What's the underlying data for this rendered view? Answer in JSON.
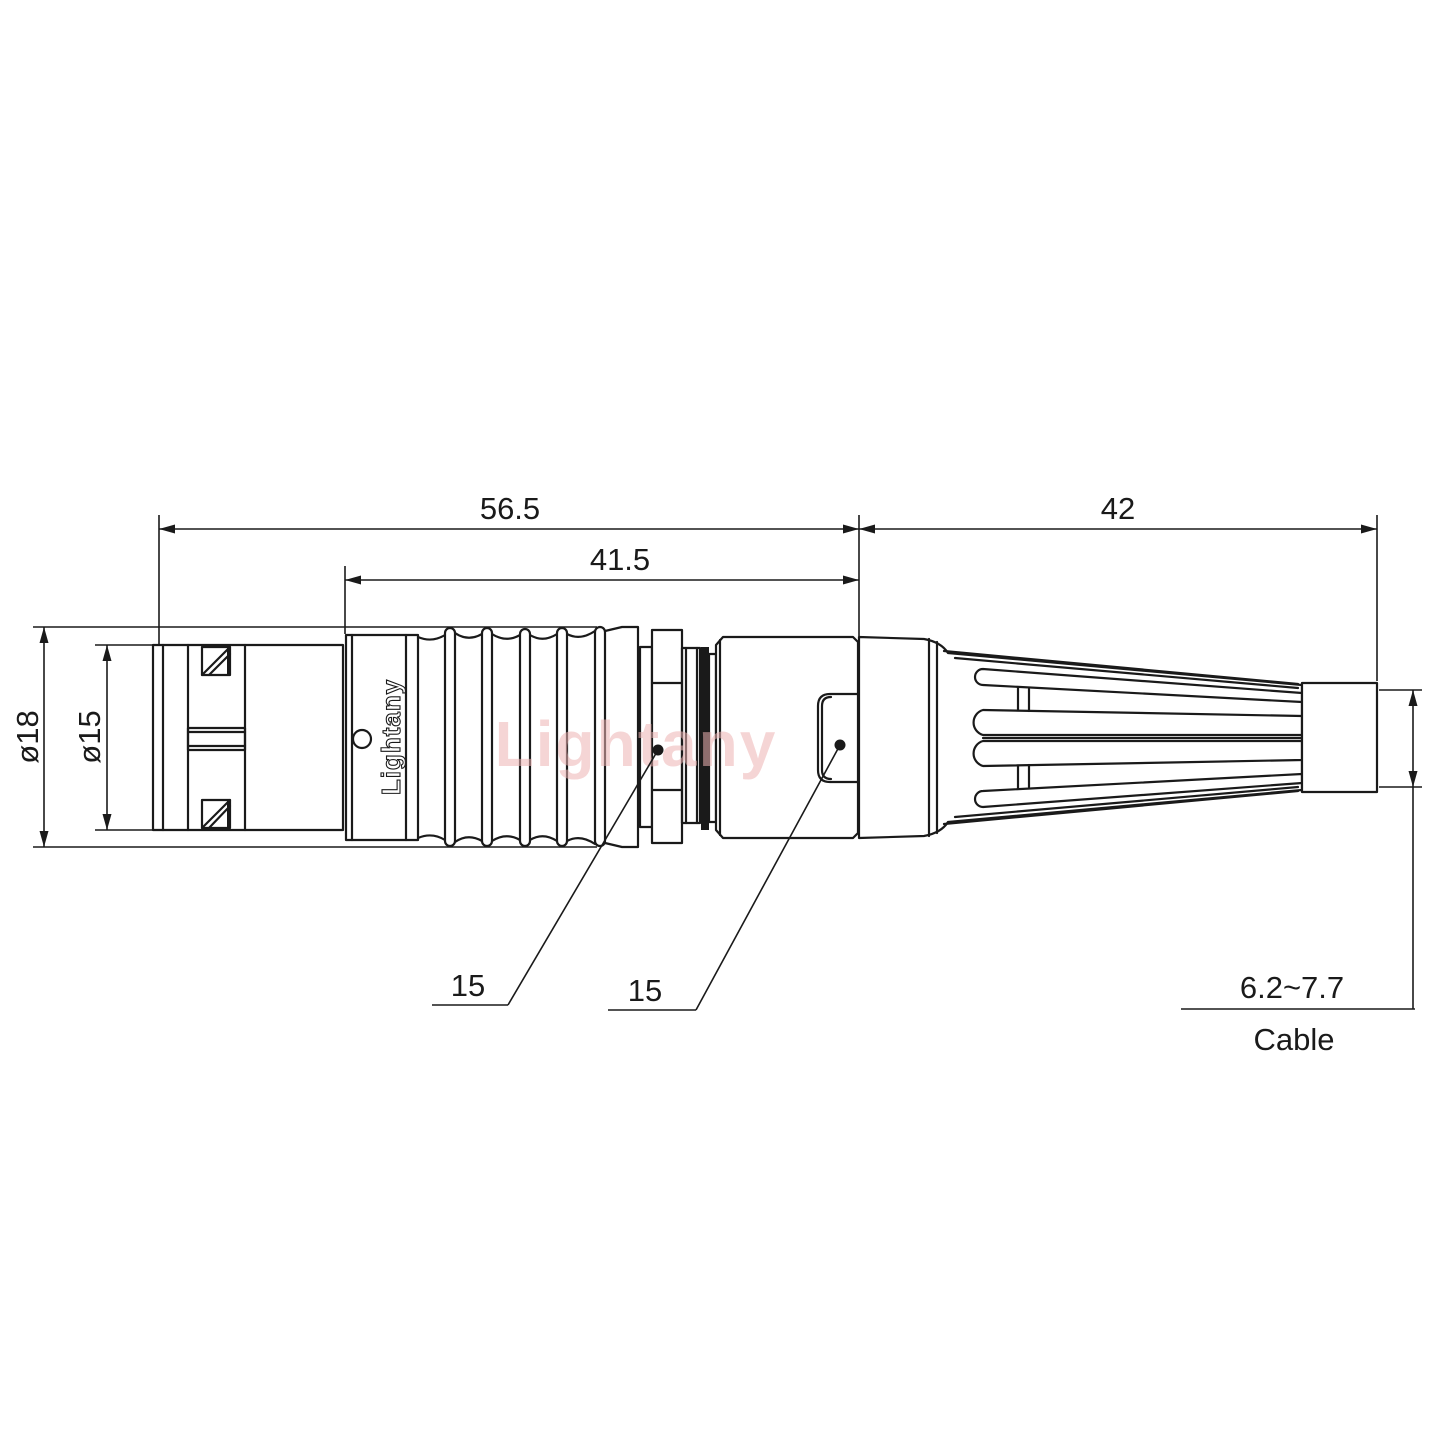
{
  "drawing": {
    "watermark_text": "Lightany",
    "body_engraving": "Lightany",
    "dimensions": {
      "total_length": "56.5",
      "front_length": "41.5",
      "boot_length": "42",
      "outer_diameter": "ø18",
      "coupling_diameter": "ø15",
      "front_nut_flats": "15",
      "rear_nut_flats": "15",
      "cable_range": "6.2~7.7",
      "cable_label": "Cable"
    },
    "colors": {
      "line": "#1a1a1a",
      "watermark": "#eeb4b4",
      "background": "#ffffff"
    }
  }
}
